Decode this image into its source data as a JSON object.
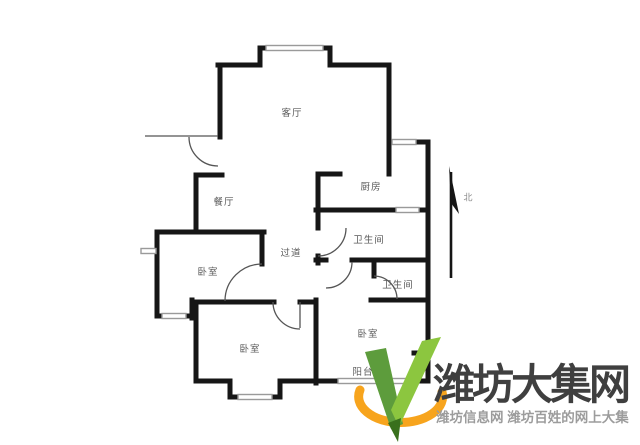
{
  "floorplan": {
    "rooms": {
      "living": "客厅",
      "dining": "餐厅",
      "kitchen": "厨房",
      "bath1": "卫生间",
      "bath2": "卫生间",
      "hallway": "过道",
      "bedroom_left": "卧室",
      "bedroom_bottom": "卧室",
      "bedroom_right": "卧室",
      "balcony": "阳台"
    },
    "compass": {
      "north_label": "北"
    },
    "colors": {
      "wall": "#161616",
      "window": "#9a9a9a",
      "door_arc": "#555555",
      "label_text": "#5a5a5a"
    }
  },
  "watermark": {
    "site_name": "潍坊大集网",
    "tagline": "潍坊信息网 潍坊百姓的网上大集",
    "title_color": "#3f3f3f",
    "tagline_color": "#9c9c9c",
    "logo_colors": {
      "dark_green": "#5d9c3c",
      "light_green": "#8cc63f",
      "nib_green": "#39701d",
      "orange": "#f7a41d"
    }
  }
}
